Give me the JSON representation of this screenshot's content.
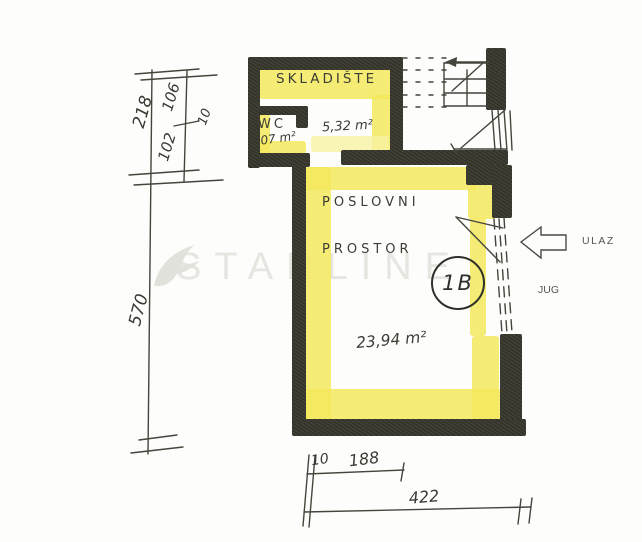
{
  "watermark": {
    "text": "STARLINE"
  },
  "plan": {
    "skladiste_label": "SKLADIŠTE",
    "skladiste_area": "5,32 m²",
    "wc_label": "WC",
    "wc_area": "1,07 m²",
    "main_label_1": "POSLOVNI",
    "main_label_2": "PROSTOR",
    "main_area": "23,94 m²",
    "unit_badge": "1B"
  },
  "annotations": {
    "entrance": "ULAZ",
    "orientation": "JUG"
  },
  "dimensions": {
    "left_total": "218",
    "seg_upper": "106",
    "seg_wall": "10",
    "seg_lower": "102",
    "height_total": "570",
    "bottom_wall": "10",
    "bottom_seg": "188",
    "bottom_total": "422"
  },
  "colors": {
    "highlight_yellow": "#f3e95d",
    "wall_black": "#34342b",
    "ink": "#45453c",
    "watermark_gray": "#e6e6e1"
  }
}
